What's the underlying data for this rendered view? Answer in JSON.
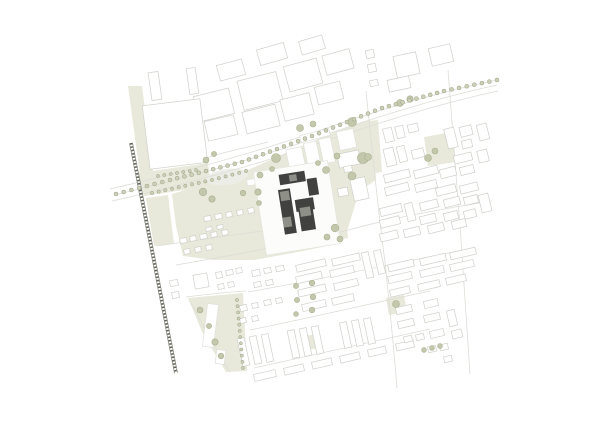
{
  "colors": {
    "background": "#ffffff",
    "outline": "#cfd0ca",
    "outline_faint": "#e0e1db",
    "road_line": "#dcddd7",
    "green": "#e8e9da",
    "tree_fill": "#c3c8ac",
    "tree_stroke": "#a9b08f",
    "avenue_dot_fill": "#ccd0b8",
    "avenue_dot_stroke": "#9aa184",
    "pond": "#ededE7",
    "railway": "#63665a",
    "site_building": "#414140",
    "site_roof": "#8e8f87",
    "plaza": "#fcfcfb",
    "plaza_stroke": "#e4e4de",
    "white_building": "#ffffff"
  },
  "map": {
    "green_areas": [
      [
        128,
        86,
        142,
        86,
        153,
        172,
        140,
        175
      ],
      [
        138,
        173,
        208,
        163,
        211,
        186,
        144,
        196
      ],
      [
        146,
        198,
        168,
        195,
        174,
        244,
        154,
        246
      ],
      [
        172,
        194,
        212,
        182,
        248,
        170,
        288,
        152,
        332,
        133,
        370,
        120,
        374,
        152,
        376,
        180,
        364,
        188,
        356,
        202,
        348,
        228,
        337,
        244,
        298,
        252,
        254,
        260,
        214,
        260,
        183,
        256,
        176,
        226
      ],
      [
        188,
        298,
        243,
        293,
        247,
        371,
        226,
        372,
        203,
        334
      ],
      [
        424,
        137,
        452,
        132,
        456,
        162,
        428,
        166
      ],
      [
        361,
        122,
        378,
        120,
        382,
        172,
        365,
        175
      ],
      [
        386,
        298,
        404,
        295,
        407,
        312,
        389,
        315
      ],
      [
        329,
        208,
        345,
        204,
        348,
        238,
        333,
        241
      ],
      [
        305,
        336,
        317,
        334,
        319,
        348,
        307,
        350
      ]
    ],
    "pond": {
      "cx": 227,
      "cy": 177,
      "rx": 21,
      "ry": 8,
      "rot": -8
    },
    "roads": [
      "M110,189 C180,173 250,154 312,133 C375,111 440,92 497,80",
      "M112,201 C182,185 252,166 314,145 C377,123 442,103 498,91",
      "M114,195 C184,179 250,160 313,139 C376,117 441,97 497,85",
      "M176,265 C240,254 300,243 352,229 C400,216 460,206 492,201",
      "M156,246 C200,240 240,234 262,231",
      "M366,91 C372,150 378,210 385,262 C390,310 394,350 397,388",
      "M448,70 C452,120 456,180 461,240 C464,290 468,340 470,374",
      "M186,297 C210,294 230,292 246,291",
      "M190,301 C202,324 216,350 230,372",
      "M248,292 C310,281 380,267 468,249",
      "M250,330 C300,320 360,306 430,291",
      "M254,368 C300,358 360,344 430,329",
      "M196,162 C220,152 246,148 268,142",
      "M195,132 a4.5,4.5 0 1,0 9,0 a4.5,4.5 0 1,0 -9,0"
    ],
    "railway": {
      "x1": 131,
      "y1": 143,
      "x2": 176,
      "y2": 373
    },
    "context_buildings": [
      [
        196,
        92,
        36,
        26,
        -14
      ],
      [
        240,
        76,
        40,
        30,
        -14
      ],
      [
        286,
        62,
        34,
        26,
        -15
      ],
      [
        324,
        52,
        28,
        20,
        -15
      ],
      [
        218,
        62,
        26,
        16,
        -15
      ],
      [
        258,
        46,
        28,
        16,
        -16
      ],
      [
        300,
        38,
        24,
        14,
        -16
      ],
      [
        206,
        118,
        30,
        20,
        -13
      ],
      [
        244,
        108,
        34,
        22,
        -14
      ],
      [
        282,
        96,
        30,
        22,
        -14
      ],
      [
        316,
        84,
        26,
        18,
        -14
      ],
      [
        188,
        68,
        9,
        26,
        -8
      ],
      [
        146,
        102,
        58,
        64,
        -7
      ],
      [
        150,
        72,
        10,
        28,
        -8
      ],
      [
        395,
        54,
        23,
        22,
        -12
      ],
      [
        430,
        46,
        22,
        18,
        -13
      ],
      [
        366,
        50,
        8,
        8,
        -12
      ],
      [
        368,
        64,
        8,
        8,
        -12
      ],
      [
        370,
        80,
        8,
        6,
        -12
      ],
      [
        388,
        78,
        22,
        12,
        -12
      ],
      [
        384,
        128,
        9,
        14,
        -14
      ],
      [
        396,
        126,
        8,
        12,
        -14
      ],
      [
        408,
        124,
        10,
        8,
        -14
      ],
      [
        385,
        148,
        10,
        18,
        -14
      ],
      [
        398,
        146,
        8,
        16,
        -14
      ],
      [
        412,
        149,
        12,
        9,
        -14
      ],
      [
        384,
        172,
        26,
        8,
        -14
      ],
      [
        414,
        168,
        24,
        8,
        -14
      ],
      [
        385,
        185,
        24,
        8,
        -14
      ],
      [
        415,
        182,
        22,
        8,
        -14
      ],
      [
        446,
        128,
        10,
        20,
        -14
      ],
      [
        460,
        126,
        12,
        10,
        -14
      ],
      [
        462,
        140,
        10,
        8,
        -14
      ],
      [
        454,
        154,
        18,
        8,
        -14
      ],
      [
        440,
        168,
        16,
        9,
        -14
      ],
      [
        460,
        166,
        14,
        8,
        -14
      ],
      [
        436,
        186,
        20,
        8,
        -14
      ],
      [
        460,
        184,
        18,
        8,
        -14
      ],
      [
        478,
        124,
        10,
        16,
        -14
      ],
      [
        478,
        150,
        10,
        12,
        -14
      ],
      [
        380,
        206,
        22,
        8,
        -14
      ],
      [
        380,
        218,
        20,
        8,
        -14
      ],
      [
        406,
        203,
        8,
        18,
        -14
      ],
      [
        420,
        201,
        18,
        8,
        -14
      ],
      [
        444,
        198,
        16,
        8,
        -14
      ],
      [
        464,
        196,
        14,
        8,
        -14
      ],
      [
        420,
        215,
        16,
        8,
        -14
      ],
      [
        444,
        212,
        14,
        8,
        -14
      ],
      [
        464,
        210,
        12,
        8,
        -14
      ],
      [
        480,
        194,
        10,
        18,
        -14
      ],
      [
        380,
        232,
        18,
        8,
        -14
      ],
      [
        404,
        228,
        16,
        8,
        -14
      ],
      [
        428,
        224,
        16,
        8,
        -14
      ],
      [
        452,
        220,
        14,
        8,
        -14
      ],
      [
        338,
        152,
        22,
        14,
        -12
      ],
      [
        352,
        178,
        15,
        22,
        -12
      ],
      [
        338,
        188,
        10,
        8,
        -12
      ],
      [
        344,
        166,
        8,
        6,
        -12
      ],
      [
        180,
        238,
        7,
        5,
        -10
      ],
      [
        190,
        236,
        6,
        5,
        -10
      ],
      [
        200,
        234,
        7,
        5,
        -10
      ],
      [
        211,
        232,
        6,
        5,
        -10
      ],
      [
        222,
        230,
        6,
        5,
        -10
      ],
      [
        184,
        249,
        6,
        5,
        -10
      ],
      [
        195,
        247,
        6,
        5,
        -10
      ],
      [
        206,
        245,
        6,
        5,
        -10
      ],
      [
        216,
        272,
        6,
        6,
        -10
      ],
      [
        226,
        270,
        7,
        5,
        -10
      ],
      [
        236,
        268,
        6,
        5,
        -10
      ],
      [
        218,
        284,
        6,
        5,
        -10
      ],
      [
        228,
        282,
        6,
        5,
        -10
      ],
      [
        252,
        270,
        8,
        6,
        -12
      ],
      [
        264,
        268,
        7,
        5,
        -12
      ],
      [
        276,
        266,
        8,
        5,
        -12
      ],
      [
        254,
        282,
        7,
        5,
        -12
      ],
      [
        266,
        280,
        7,
        5,
        -12
      ],
      [
        240,
        305,
        7,
        6,
        -12
      ],
      [
        252,
        303,
        6,
        5,
        -12
      ],
      [
        264,
        300,
        7,
        5,
        -12
      ],
      [
        276,
        298,
        6,
        5,
        -12
      ],
      [
        240,
        318,
        6,
        5,
        -12
      ],
      [
        252,
        316,
        6,
        5,
        -12
      ],
      [
        170,
        280,
        8,
        6,
        -10
      ],
      [
        172,
        292,
        7,
        6,
        -10
      ],
      [
        194,
        274,
        14,
        14,
        -10
      ],
      [
        204,
        216,
        7,
        5,
        -10
      ],
      [
        215,
        214,
        7,
        5,
        -10
      ],
      [
        226,
        212,
        6,
        5,
        -10
      ],
      [
        237,
        210,
        6,
        5,
        -10
      ],
      [
        248,
        208,
        6,
        5,
        -10
      ],
      [
        206,
        227,
        6,
        4,
        -10
      ],
      [
        217,
        225,
        6,
        4,
        -10
      ],
      [
        296,
        262,
        30,
        7,
        -13
      ],
      [
        332,
        256,
        28,
        7,
        -13
      ],
      [
        296,
        274,
        26,
        7,
        -13
      ],
      [
        330,
        268,
        24,
        7,
        -13
      ],
      [
        298,
        287,
        28,
        7,
        -13
      ],
      [
        334,
        281,
        24,
        7,
        -13
      ],
      [
        364,
        252,
        7,
        26,
        -13
      ],
      [
        376,
        250,
        7,
        24,
        -13
      ],
      [
        388,
        262,
        26,
        7,
        -13
      ],
      [
        388,
        274,
        24,
        7,
        -13
      ],
      [
        420,
        256,
        26,
        7,
        -13
      ],
      [
        420,
        268,
        24,
        7,
        -13
      ],
      [
        450,
        250,
        26,
        7,
        -13
      ],
      [
        450,
        262,
        24,
        7,
        -13
      ],
      [
        302,
        302,
        24,
        7,
        -13
      ],
      [
        332,
        296,
        22,
        7,
        -13
      ],
      [
        390,
        288,
        20,
        7,
        -13
      ],
      [
        418,
        282,
        22,
        7,
        -13
      ],
      [
        446,
        276,
        20,
        7,
        -13
      ],
      [
        240,
        338,
        7,
        28,
        -12
      ],
      [
        252,
        336,
        7,
        28,
        -12
      ],
      [
        264,
        334,
        7,
        28,
        -12
      ],
      [
        290,
        330,
        7,
        28,
        -12
      ],
      [
        302,
        328,
        7,
        28,
        -12
      ],
      [
        314,
        326,
        7,
        28,
        -12
      ],
      [
        342,
        322,
        7,
        26,
        -12
      ],
      [
        354,
        320,
        7,
        26,
        -12
      ],
      [
        366,
        318,
        7,
        26,
        -12
      ],
      [
        254,
        372,
        22,
        7,
        -13
      ],
      [
        284,
        366,
        20,
        7,
        -13
      ],
      [
        312,
        360,
        20,
        7,
        -13
      ],
      [
        340,
        354,
        20,
        7,
        -13
      ],
      [
        368,
        348,
        18,
        7,
        -13
      ],
      [
        396,
        342,
        18,
        7,
        -13
      ],
      [
        398,
        320,
        16,
        7,
        -13
      ],
      [
        424,
        314,
        16,
        7,
        -13
      ],
      [
        396,
        306,
        16,
        7,
        -13
      ],
      [
        424,
        300,
        14,
        7,
        -13
      ],
      [
        448,
        310,
        8,
        16,
        -13
      ],
      [
        430,
        330,
        14,
        7,
        -13
      ],
      [
        404,
        336,
        8,
        6,
        -13
      ],
      [
        416,
        334,
        8,
        6,
        -13
      ],
      [
        428,
        346,
        8,
        6,
        -13
      ],
      [
        440,
        344,
        8,
        6,
        -13
      ],
      [
        452,
        330,
        10,
        8,
        -13
      ],
      [
        444,
        356,
        8,
        6,
        -13
      ]
    ],
    "white_buildings": [
      [
        288,
        148,
        16,
        24,
        -12
      ],
      [
        306,
        142,
        13,
        27,
        -12
      ],
      [
        321,
        138,
        12,
        25,
        -12
      ],
      [
        300,
        132,
        30,
        7,
        -14
      ],
      [
        338,
        130,
        17,
        19,
        -12
      ],
      [
        262,
        186,
        9,
        19,
        -8
      ],
      [
        247,
        179,
        11,
        6,
        -8
      ],
      [
        205,
        304,
        11,
        43,
        7
      ],
      [
        216,
        350,
        9,
        14,
        7
      ]
    ],
    "site_plaza": [
      [
        259,
        166,
        75,
        84,
        0
      ]
    ],
    "site_buildings": [
      [
        283.5,
        172.5,
        26,
        10.5,
        0
      ],
      [
        310.5,
        181,
        10,
        17,
        0
      ],
      [
        280.5,
        187.5,
        12,
        45,
        0
      ],
      [
        295.5,
        200,
        18.5,
        12,
        0
      ],
      [
        297.5,
        200,
        14.5,
        32,
        0
      ]
    ],
    "site_roofs": [
      [
        293.5,
        174.5,
        7.5,
        6.5,
        0
      ],
      [
        282,
        189.5,
        9,
        9.5,
        0
      ],
      [
        280.5,
        215.5,
        8.5,
        10,
        0
      ],
      [
        299,
        208.5,
        10.5,
        9,
        0
      ]
    ],
    "park_trees": [
      [
        260,
        175,
        3
      ],
      [
        272,
        169,
        2.5
      ],
      [
        258,
        192,
        3.2
      ],
      [
        259,
        203,
        2.5
      ],
      [
        276,
        158,
        4.5
      ],
      [
        300,
        128,
        3.5
      ],
      [
        313,
        124,
        3
      ],
      [
        352,
        122,
        4.5
      ],
      [
        363,
        158,
        5.5
      ],
      [
        337,
        156,
        3
      ],
      [
        326,
        170,
        3.5
      ],
      [
        352,
        176,
        4
      ],
      [
        318,
        163,
        2.5
      ],
      [
        335,
        228,
        3.8
      ],
      [
        327,
        237,
        3
      ],
      [
        340,
        239,
        3
      ],
      [
        368,
        157,
        3.5
      ],
      [
        428,
        158,
        3.5
      ],
      [
        435,
        151,
        3
      ],
      [
        396,
        304,
        3.5
      ],
      [
        203,
        192,
        3.8
      ],
      [
        212,
        199,
        3.2
      ],
      [
        243,
        193,
        2.8
      ],
      [
        206,
        160,
        3
      ],
      [
        214,
        154,
        2.6
      ],
      [
        200,
        310,
        3
      ],
      [
        209,
        326,
        2.6
      ],
      [
        215,
        342,
        3.2
      ],
      [
        221,
        356,
        2.8
      ],
      [
        312,
        283,
        2.8
      ],
      [
        313,
        297,
        2.8
      ],
      [
        312,
        310,
        2.8
      ],
      [
        296,
        286,
        2.6
      ],
      [
        297,
        300,
        2.6
      ],
      [
        296,
        314,
        2.4
      ],
      [
        424,
        350,
        2.4
      ],
      [
        432,
        348,
        2.4
      ],
      [
        440,
        346,
        2.4
      ],
      [
        400,
        103,
        3.4
      ],
      [
        410,
        99,
        3.2
      ]
    ],
    "tree_lines": [
      {
        "pts": [
          [
            116,
            194
          ],
          [
            170,
            180
          ],
          [
            242,
            162
          ],
          [
            312,
            136
          ],
          [
            382,
            108
          ],
          [
            444,
            91
          ],
          [
            497,
            80
          ]
        ],
        "gap": 7.5,
        "r": 2.0
      },
      {
        "pts": [
          [
            152,
            193
          ],
          [
            212,
            180
          ],
          [
            246,
            171
          ]
        ],
        "gap": 7,
        "r": 1.7
      },
      {
        "pts": [
          [
            158,
            176
          ],
          [
            196,
            170
          ]
        ],
        "gap": 6,
        "r": 1.6
      },
      {
        "pts": [
          [
            237,
            300
          ],
          [
            243,
            368
          ]
        ],
        "gap": 6.5,
        "r": 1.6
      }
    ]
  }
}
